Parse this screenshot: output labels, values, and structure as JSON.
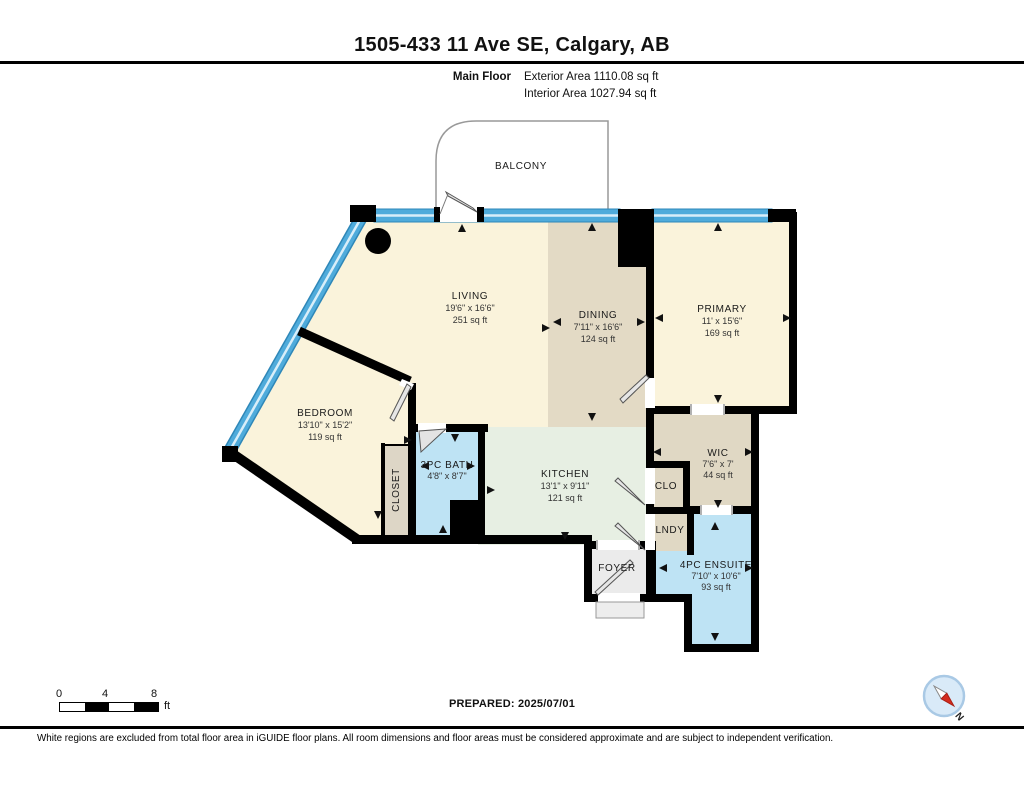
{
  "page": {
    "title": "1505-433 11 Ave SE, Calgary, AB",
    "floor_label": "Main Floor",
    "exterior_area": "Exterior Area 1110.08 sq ft",
    "interior_area": "Interior Area 1027.94 sq ft",
    "prepared": "PREPARED: 2025/07/01",
    "disclaimer": "White regions are excluded from total floor area in iGUIDE floor plans. All room dimensions and floor areas must be considered approximate and are subject to independent verification."
  },
  "scale": {
    "ticks": [
      "0",
      "4",
      "8"
    ],
    "unit": "ft"
  },
  "compass": {
    "north_label": "N"
  },
  "colors": {
    "room_cream": "#FAF3DB",
    "room_tan": "#E3DAC5",
    "room_mint": "#E7EFE3",
    "room_blue": "#BEE3F4",
    "floor_gray": "#EBEBEB",
    "window_blue": "#4FABDB",
    "wall_black": "#000000"
  },
  "rooms": [
    {
      "name": "BALCONY"
    },
    {
      "name": "LIVING",
      "dims": "19'6\" x 16'6\"",
      "area": "251 sq ft"
    },
    {
      "name": "DINING",
      "dims": "7'11\" x 16'6\"",
      "area": "124 sq ft"
    },
    {
      "name": "PRIMARY",
      "dims": "11' x 15'6\"",
      "area": "169 sq ft"
    },
    {
      "name": "BEDROOM",
      "dims": "13'10\" x 15'2\"",
      "area": "119 sq ft"
    },
    {
      "name": "3PC BATH",
      "dims": "4'8\" x 8'7\""
    },
    {
      "name": "CLOSET"
    },
    {
      "name": "KITCHEN",
      "dims": "13'1\" x 9'11\"",
      "area": "121 sq ft"
    },
    {
      "name": "WIC",
      "dims": "7'6\" x 7'",
      "area": "44 sq ft"
    },
    {
      "name": "CLO"
    },
    {
      "name": "LNDY"
    },
    {
      "name": "FOYER"
    },
    {
      "name": "4PC ENSUITE",
      "dims": "7'10\" x 10'6\"",
      "area": "93 sq ft"
    }
  ]
}
